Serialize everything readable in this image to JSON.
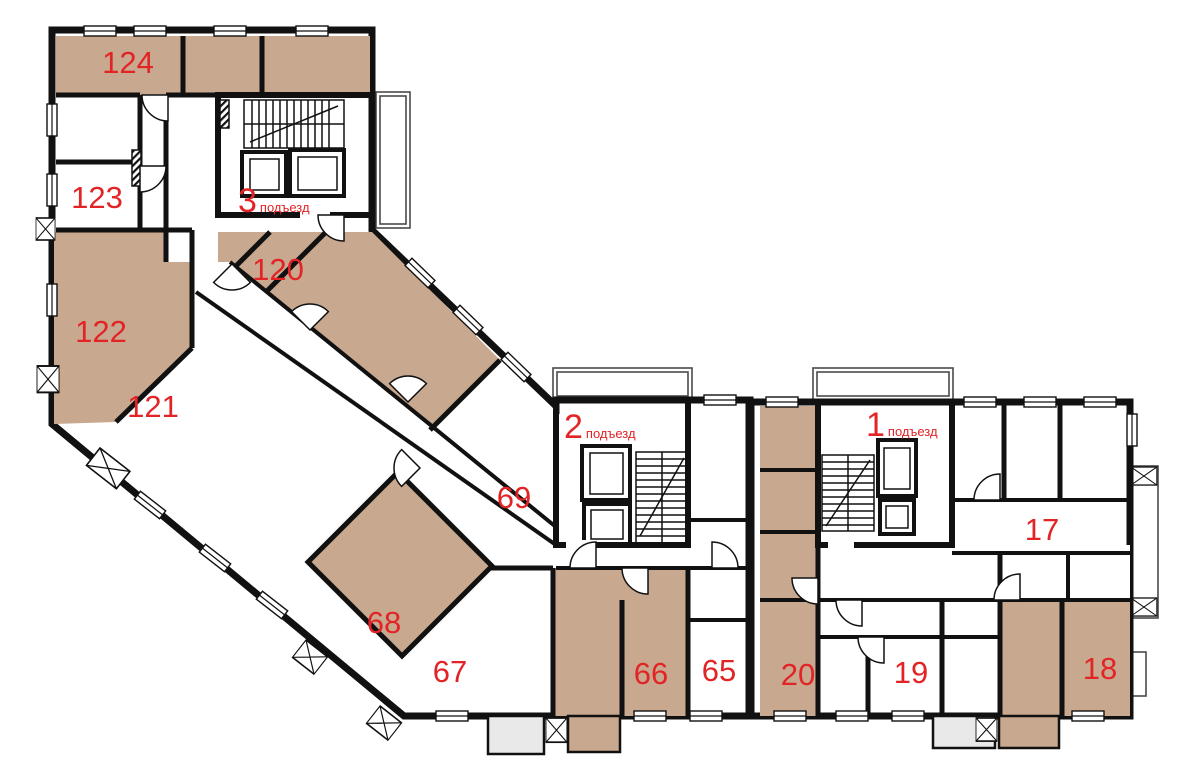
{
  "plan": {
    "colors": {
      "room_tan": "#c8a88e",
      "room_gray": "#e9e9e9",
      "wall": "#111111",
      "label_red": "#e22426",
      "balcony": "#4a4a4a"
    },
    "apartments": [
      {
        "number": "124"
      },
      {
        "number": "123"
      },
      {
        "number": "122"
      },
      {
        "number": "121"
      },
      {
        "number": "120"
      },
      {
        "number": "69"
      },
      {
        "number": "68"
      },
      {
        "number": "67"
      },
      {
        "number": "66"
      },
      {
        "number": "65"
      },
      {
        "number": "20"
      },
      {
        "number": "19"
      },
      {
        "number": "18"
      },
      {
        "number": "17"
      }
    ],
    "entrances": [
      {
        "number": "3",
        "label": "подъезд"
      },
      {
        "number": "2",
        "label": "подъезд"
      },
      {
        "number": "1",
        "label": "подъезд"
      }
    ]
  }
}
